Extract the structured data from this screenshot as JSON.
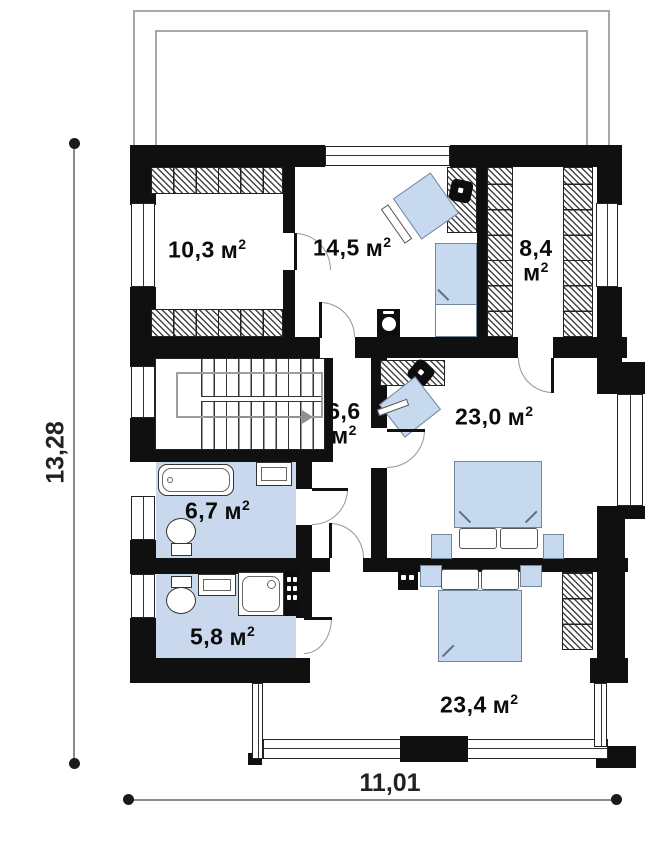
{
  "plan_type": "floor-plan",
  "rooms": [
    {
      "name": "bedroom-1",
      "value": "10,3",
      "unit": "м",
      "sup": "2"
    },
    {
      "name": "bedroom-2",
      "value": "14,5",
      "unit": "м",
      "sup": "2"
    },
    {
      "name": "closet",
      "value": "8,4",
      "unit": "м",
      "sup": "2"
    },
    {
      "name": "hall",
      "value": "6,6",
      "unit": "м",
      "sup": "2"
    },
    {
      "name": "bedroom-3",
      "value": "23,0",
      "unit": "м",
      "sup": "2"
    },
    {
      "name": "bathroom-1",
      "value": "6,7",
      "unit": "м",
      "sup": "2"
    },
    {
      "name": "bathroom-2",
      "value": "5,8",
      "unit": "м",
      "sup": "2"
    },
    {
      "name": "bedroom-4",
      "value": "23,4",
      "unit": "м",
      "sup": "2"
    }
  ],
  "dimensions": {
    "height": "13,28",
    "width": "11,01"
  },
  "colors": {
    "wall": "#101010",
    "bathroom_floor": "#c9d8ec",
    "furniture_fill": "#c7d9ee",
    "dimension_line": "#8c8c8c",
    "door_arc": "#969696",
    "terrace_outline": "#a8a8a8"
  },
  "fixtures": [
    "bathtub",
    "toilet",
    "washbasin",
    "shower-cabin",
    "staircase",
    "double-bed",
    "single-bed",
    "desk",
    "office-chair",
    "wardrobe-shelves",
    "ventilation-shaft",
    "boiler",
    "nightstand",
    "pillow",
    "terrace",
    "window",
    "door"
  ]
}
